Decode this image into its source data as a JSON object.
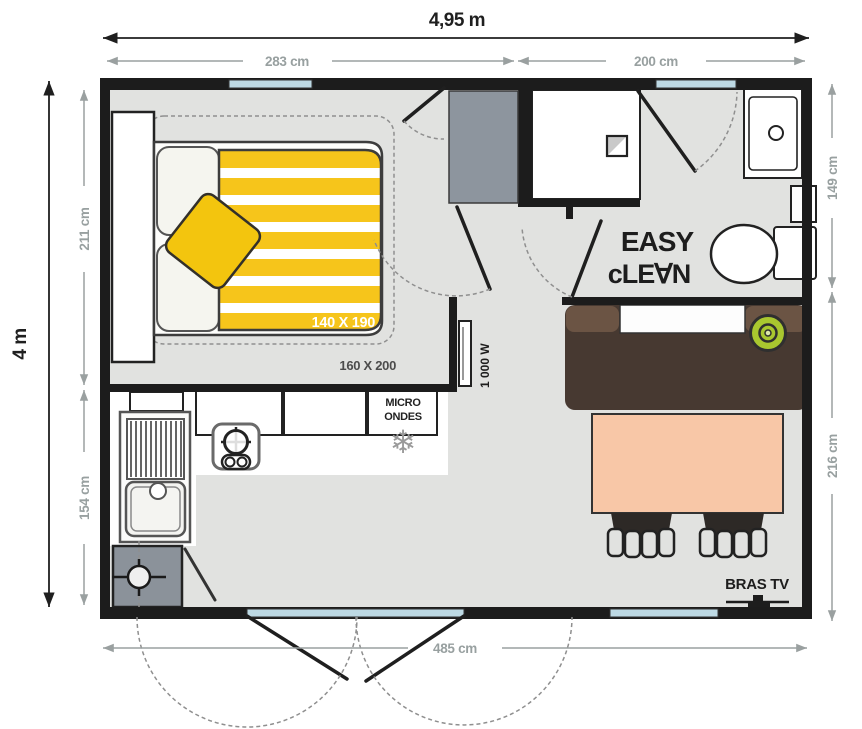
{
  "plan": {
    "type": "mobile-home floor plan, top view",
    "dimensions": {
      "overall_width": "4,95 m",
      "overall_height": "4 m",
      "top_left_section": "283 cm",
      "top_right_section": "200 cm",
      "left_upper_section": "211 cm",
      "left_lower_section": "154 cm",
      "right_upper_section": "149 cm",
      "right_lower_section": "216 cm",
      "bottom_total": "485 cm"
    },
    "labels": {
      "bed_size": "140 X 190",
      "rug_size": "160 X 200",
      "heater_power": "1 000 W",
      "microwave_line1": "MICRO",
      "microwave_line2": "ONDES",
      "logo_line1": "EASY",
      "logo_line2": "cLE∀N",
      "tv_bracket": "BRAS TV",
      "fridge_icon_glyph": "❄"
    },
    "colors": {
      "floor": "#e1e2e0",
      "wall": "#1c1c1c",
      "window_glass": "#bdd9e4",
      "wardrobe_gray": "#8d959e",
      "water_heater_gray": "#8b929a",
      "duvet_yellow": "#f6c51b",
      "cushion_yellow": "#f3c50e",
      "sofa_brown": "#473931",
      "sofa_arm_brown": "#6b5444",
      "green_cushion": "#a9c72f",
      "table_peach": "#f8c7a7",
      "chair_dark": "#2d2926",
      "dim_gray": "#9aa0a0",
      "ink": "#1f1f1f"
    }
  }
}
